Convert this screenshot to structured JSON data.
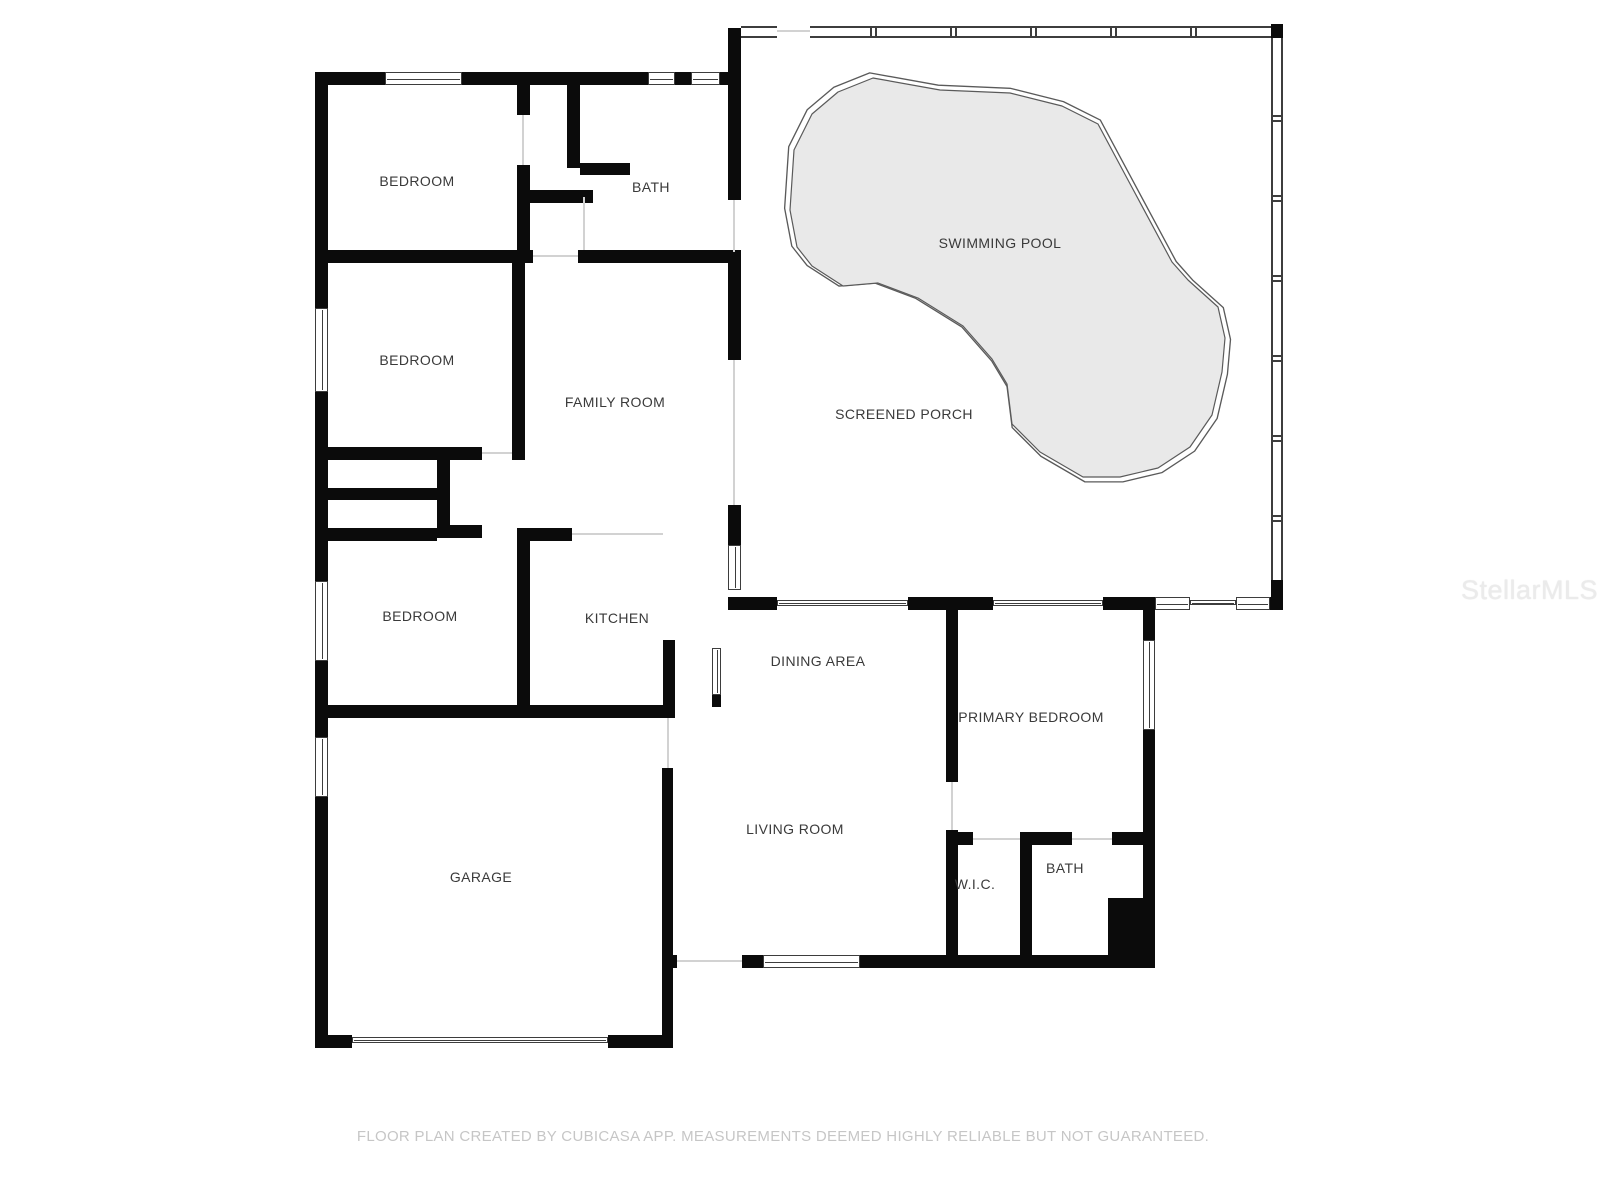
{
  "rooms": [
    {
      "id": "bedroom-1",
      "label": "BEDROOM"
    },
    {
      "id": "bath-1",
      "label": "BATH"
    },
    {
      "id": "bedroom-2",
      "label": "BEDROOM"
    },
    {
      "id": "family-room",
      "label": "FAMILY ROOM"
    },
    {
      "id": "swimming-pool",
      "label": "SWIMMING POOL"
    },
    {
      "id": "screened-porch",
      "label": "SCREENED PORCH"
    },
    {
      "id": "bedroom-3",
      "label": "BEDROOM"
    },
    {
      "id": "kitchen",
      "label": "KITCHEN"
    },
    {
      "id": "dining-area",
      "label": "DINING AREA"
    },
    {
      "id": "primary-bedroom",
      "label": "PRIMARY BEDROOM"
    },
    {
      "id": "living-room",
      "label": "LIVING ROOM"
    },
    {
      "id": "garage",
      "label": "GARAGE"
    },
    {
      "id": "wic",
      "label": "W.I.C."
    },
    {
      "id": "bath-2",
      "label": "BATH"
    }
  ],
  "footer": {
    "text": "FLOOR PLAN CREATED BY CUBICASA APP. MEASUREMENTS DEEMED HIGHLY RELIABLE BUT NOT GUARANTEED."
  },
  "watermark": {
    "text": "StellarMLS"
  },
  "colors": {
    "background": "#ffffff",
    "wall": "#0b0b0b",
    "line": "#3d3d3d",
    "pool_fill": "#e9e9e9",
    "pool_stroke": "#5a5a5a",
    "label_text": "#3a3a3a",
    "footer_text": "#c6c6c6",
    "watermark_text": "#ebebeb"
  }
}
